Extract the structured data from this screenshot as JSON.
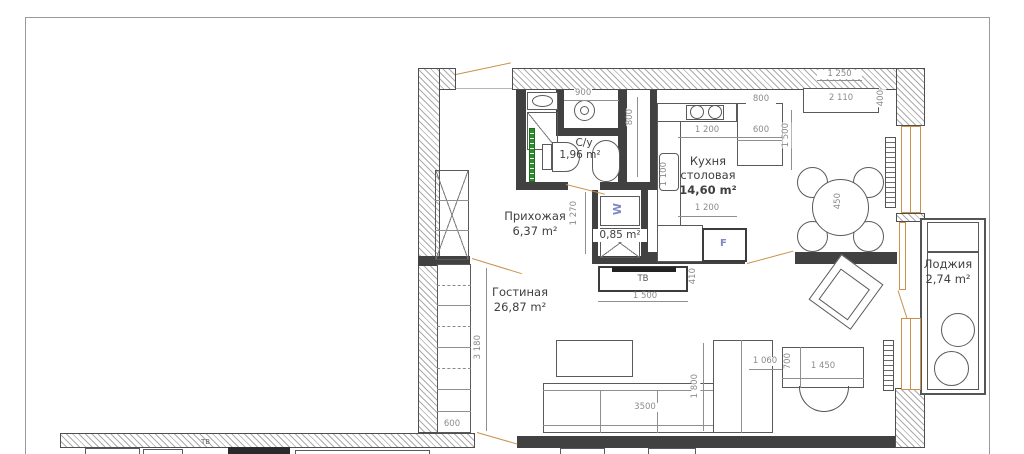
{
  "rooms": {
    "hallway": {
      "name": "Прихожая",
      "area": "6,37 m²"
    },
    "bathroom": {
      "name": "С/у",
      "area": "1,96 m²"
    },
    "laundry": {
      "area": "0,85 m²"
    },
    "kitchen": {
      "name_line1": "Кухня",
      "name_line2": "столовая",
      "area": "14,60 m²"
    },
    "living": {
      "name": "Гостиная",
      "area": "26,87 m²"
    },
    "loggia": {
      "name": "Лоджия",
      "area": "2,74 m²"
    }
  },
  "dims": {
    "d900": "900",
    "d800_shaft": "800",
    "d1270": "1 270",
    "d1250": "1 250",
    "d2110": "2 110",
    "d400": "400",
    "d800_cab": "800",
    "d1200_top": "1 200",
    "d600_top": "600",
    "d1500_kitchen": "1 500",
    "d1100_sink": "1 100",
    "d1200_bottom": "1 200",
    "d450_table": "450",
    "d1500_tv": "1 500",
    "d410_tv": "410",
    "d3180_living": "3 180",
    "d600_living": "600",
    "d3500_sofa": "3500",
    "d1800_sofa": "1 800",
    "d1060_desk": "1 060",
    "d700_desk": "700",
    "d1450_desk": "1 450"
  },
  "labels": {
    "tv": "ТВ",
    "tv_lower": "ТВ",
    "washer": "W",
    "fridge": "F"
  },
  "colors": {
    "wall": "#414141",
    "hatch": "#ababab",
    "joinery": "#c9914a",
    "towel_rail": "#2e8b2e",
    "marker_blue": "#7d88c2",
    "dim_text": "#8b8b8b"
  }
}
